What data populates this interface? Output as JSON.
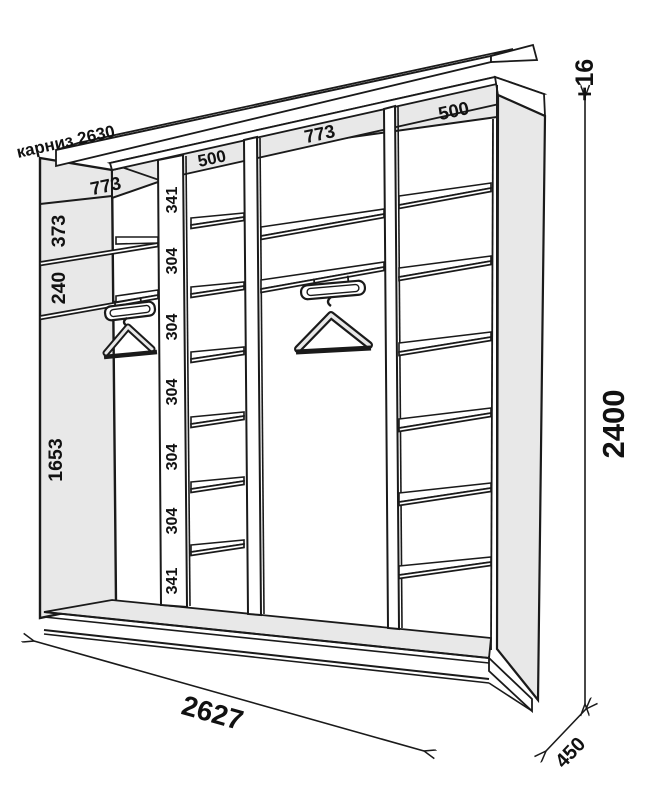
{
  "diagram": {
    "cornice_label": "карниз 2630",
    "section_widths": [
      "773",
      "500",
      "773",
      "500"
    ],
    "left_dims": [
      "373",
      "240",
      "1653"
    ],
    "shelf_dims": [
      "341",
      "304",
      "304",
      "304",
      "304",
      "304",
      "341"
    ],
    "height_total": "2400",
    "height_extra": "+16",
    "width_total": "2627",
    "depth": "450",
    "colors": {
      "panel_gray": "#e8e8e8",
      "line": "#1a1a1a"
    }
  }
}
